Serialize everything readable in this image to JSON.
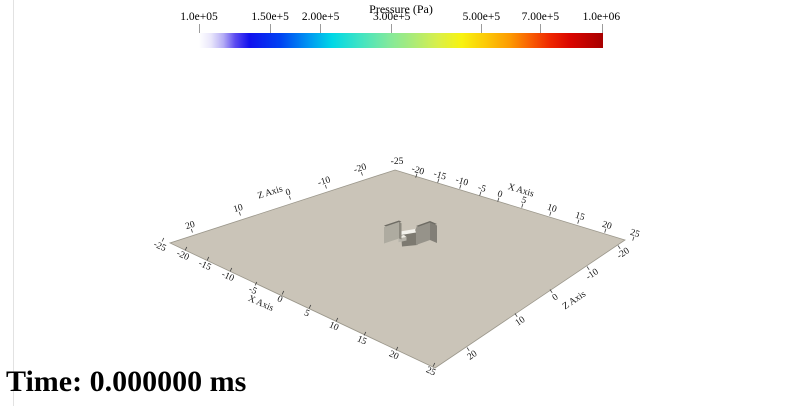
{
  "colorbar": {
    "title": "Pressure (Pa)",
    "scale": "log",
    "tick_labels": [
      "1.0e+05",
      "1.50e+5",
      "2.00e+5",
      "3.00e+5",
      "5.00e+5",
      "7.00e+5",
      "1.0e+06"
    ],
    "gradient_stops": [
      {
        "color": "#ffffff",
        "pos": "0%"
      },
      {
        "color": "#e9e6fb",
        "pos": "3%"
      },
      {
        "color": "#b5adf5",
        "pos": "6%"
      },
      {
        "color": "#5b4af0",
        "pos": "9%"
      },
      {
        "color": "#1111ee",
        "pos": "12.5%"
      },
      {
        "color": "#0041f2",
        "pos": "20%"
      },
      {
        "color": "#0095f2",
        "pos": "27%"
      },
      {
        "color": "#00d8e6",
        "pos": "33%"
      },
      {
        "color": "#41e4c3",
        "pos": "40%"
      },
      {
        "color": "#82e99c",
        "pos": "47%"
      },
      {
        "color": "#abeb78",
        "pos": "53%"
      },
      {
        "color": "#d8ef4b",
        "pos": "59%"
      },
      {
        "color": "#f8f310",
        "pos": "65%"
      },
      {
        "color": "#fcc907",
        "pos": "71%"
      },
      {
        "color": "#fd9a02",
        "pos": "77%"
      },
      {
        "color": "#f95f03",
        "pos": "82%"
      },
      {
        "color": "#ee2600",
        "pos": "87%"
      },
      {
        "color": "#d90500",
        "pos": "92%"
      },
      {
        "color": "#a70000",
        "pos": "100%"
      }
    ]
  },
  "scene": {
    "x_axis_title": "X Axis",
    "z_axis_title": "Z Axis",
    "corner_label": "-25",
    "far_z_labels": [
      "20",
      "10",
      "0",
      "-10",
      "-20"
    ],
    "far_x_labels": [
      "-20",
      "-15",
      "-10",
      "-5",
      "0",
      "5",
      "10",
      "15",
      "20",
      "25"
    ],
    "near_x_labels": [
      "-25",
      "-20",
      "-15",
      "-10",
      "-5",
      "0",
      "5",
      "10",
      "15",
      "20",
      "25"
    ],
    "near_z_labels": [
      "-20",
      "-10",
      "0",
      "10",
      "20"
    ],
    "ground_color": "#cac4b8"
  },
  "time_display": {
    "text": "Time: 0.000000 ms"
  },
  "chart_data": {
    "type": "heatmap",
    "subtype": "3d-surface-pseudocolor",
    "title": "Pressure (Pa)",
    "colorbar": {
      "label": "Pressure (Pa)",
      "scale": "log",
      "min": 100000,
      "max": 1000000,
      "tick_values": [
        100000,
        150000,
        200000,
        300000,
        500000,
        700000,
        1000000
      ],
      "tick_labels": [
        "1.0e+05",
        "1.50e+5",
        "2.00e+5",
        "3.00e+5",
        "5.00e+5",
        "7.00e+5",
        "1.0e+06"
      ],
      "colormap": "white-blue-cyan-green-yellow-orange-red (rainbow)"
    },
    "x_axis": {
      "label": "X Axis",
      "range": [
        -25,
        25
      ],
      "tick_step": 5
    },
    "z_axis": {
      "label": "Z Axis",
      "range": [
        -25,
        25
      ],
      "tick_step": 10
    },
    "time_annotation": "Time: 0.000000 ms",
    "description": "3D view of a flat 50x50 ground plane (uniform tan pressure surface) with a small I-shaped obstacle geometry near the origin at simulation time 0."
  }
}
